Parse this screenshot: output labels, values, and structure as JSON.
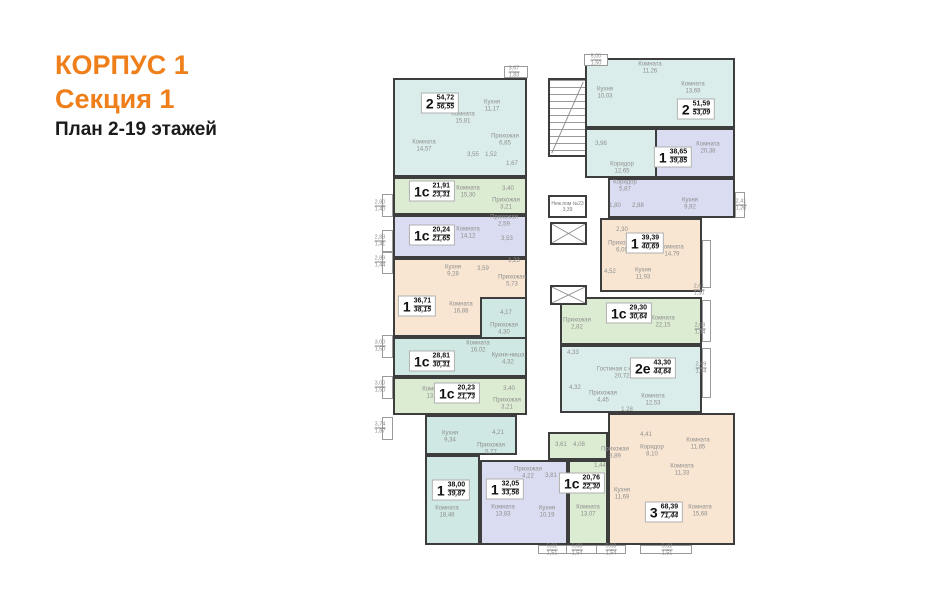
{
  "header": {
    "building": "КОРПУС 1",
    "section": "Секция 1",
    "plan": "План 2-19 этажей"
  },
  "palette": {
    "orange_accent": "#ef7f1a",
    "cyan_apt": "#daedeb",
    "green_apt": "#dcecd2",
    "lavender_apt": "#dadcf1",
    "peach_apt": "#f8e6d2",
    "teal_apt": "#cfe8e3",
    "walls": "#3d3d3d"
  },
  "apartments": [
    {
      "type": "2",
      "area_main": "54,72",
      "area_total": "56,55",
      "rooms": [
        {
          "name": "Комната",
          "area": "15,81"
        },
        {
          "name": "Комната",
          "area": "14,57"
        },
        {
          "name": "Кухня",
          "area": "11,17"
        },
        {
          "name": "Прихожая",
          "area": "6,85"
        },
        {
          "name": "",
          "area": "3,55"
        },
        {
          "name": "",
          "area": "1,52"
        },
        {
          "name": "",
          "area": "1,67"
        }
      ]
    },
    {
      "type": "1с",
      "area_main": "21,91",
      "area_total": "23,31",
      "rooms": [
        {
          "name": "Комната",
          "area": "15,30"
        },
        {
          "name": "Прихожая",
          "area": "3,21"
        },
        {
          "name": "",
          "area": "3,40"
        }
      ]
    },
    {
      "type": "1с",
      "area_main": "20,24",
      "area_total": "21,65",
      "rooms": [
        {
          "name": "Комната",
          "area": "14,12"
        },
        {
          "name": "Прихожая",
          "area": "2,59"
        },
        {
          "name": "",
          "area": "3,53"
        }
      ]
    },
    {
      "type": "1",
      "area_main": "36,71",
      "area_total": "38,15",
      "rooms": [
        {
          "name": "Комната",
          "area": "16,88"
        },
        {
          "name": "Кухня",
          "area": "9,28"
        },
        {
          "name": "Прихожая",
          "area": "5,73"
        },
        {
          "name": "",
          "area": "3,59"
        },
        {
          "name": "",
          "area": "1,23"
        }
      ]
    },
    {
      "type": "1с",
      "area_main": "28,81",
      "area_total": "30,31",
      "rooms": [
        {
          "name": "Комната",
          "area": "16,02"
        },
        {
          "name": "Кухня-ниша",
          "area": "4,32"
        },
        {
          "name": "Прихожая",
          "area": "4,30"
        },
        {
          "name": "",
          "area": "4,17"
        }
      ]
    },
    {
      "type": "1с",
      "area_main": "20,23",
      "area_total": "21,73",
      "rooms": [
        {
          "name": "Комната",
          "area": "13,62"
        },
        {
          "name": "Прихожая",
          "area": "3,21"
        },
        {
          "name": "",
          "area": "3,40"
        }
      ]
    },
    {
      "type": "1",
      "area_main": "38,00",
      "area_total": "39,87",
      "rooms": [
        {
          "name": "Комната",
          "area": "18,48"
        },
        {
          "name": "Кухня",
          "area": "9,34"
        },
        {
          "name": "Прихожая",
          "area": "5,77"
        },
        {
          "name": "",
          "area": "4,21"
        }
      ]
    },
    {
      "type": "1",
      "area_main": "32,05",
      "area_total": "33,56",
      "rooms": [
        {
          "name": "Комната",
          "area": "13,83"
        },
        {
          "name": "Кухня",
          "area": "10,19"
        },
        {
          "name": "Прихожая",
          "area": "4,22"
        },
        {
          "name": "",
          "area": "3,81"
        }
      ]
    },
    {
      "type": "1с",
      "area_main": "20,76",
      "area_total": "22,30",
      "rooms": [
        {
          "name": "Комната",
          "area": "13,07"
        },
        {
          "name": "",
          "area": "3,61"
        },
        {
          "name": "",
          "area": "4,08"
        },
        {
          "name": "",
          "area": "1,44"
        }
      ]
    },
    {
      "type": "3",
      "area_main": "68,39",
      "area_total": "71,44",
      "rooms": [
        {
          "name": "Комната",
          "area": "15,68"
        },
        {
          "name": "Комната",
          "area": "11,85"
        },
        {
          "name": "Комната",
          "area": "11,33"
        },
        {
          "name": "Кухня",
          "area": "11,69"
        },
        {
          "name": "Коридор",
          "area": "8,10"
        },
        {
          "name": "Прихожая",
          "area": "3,89"
        },
        {
          "name": "",
          "area": "4,41"
        }
      ]
    },
    {
      "type": "2е",
      "area_main": "43,30",
      "area_total": "44,64",
      "rooms": [
        {
          "name": "Гостиная с кухней",
          "area": "20,72"
        },
        {
          "name": "Комната",
          "area": "12,53"
        },
        {
          "name": "Прихожая",
          "area": "4,45"
        },
        {
          "name": "",
          "area": "4,33"
        },
        {
          "name": "",
          "area": "4,32"
        },
        {
          "name": "",
          "area": "1,28"
        }
      ]
    },
    {
      "type": "1с",
      "area_main": "29,30",
      "area_total": "30,64",
      "rooms": [
        {
          "name": "Комната",
          "area": "22,15"
        },
        {
          "name": "Прихожая",
          "area": "2,82"
        }
      ]
    },
    {
      "type": "1",
      "area_main": "39,39",
      "area_total": "40,69",
      "rooms": [
        {
          "name": "Комната",
          "area": "14,79"
        },
        {
          "name": "Кухня",
          "area": "11,93"
        },
        {
          "name": "Прихожая",
          "area": "6,05"
        },
        {
          "name": "",
          "area": "4,52"
        },
        {
          "name": "",
          "area": "2,30"
        }
      ]
    },
    {
      "type": "1",
      "area_main": "38,65",
      "area_total": "39,85",
      "rooms": [
        {
          "name": "Комната",
          "area": "20,38"
        },
        {
          "name": "Кухня",
          "area": "9,92"
        },
        {
          "name": "Коридор",
          "area": "5,87"
        },
        {
          "name": "",
          "area": "1,80"
        },
        {
          "name": "",
          "area": "2,88"
        }
      ]
    },
    {
      "type": "2",
      "area_main": "51,59",
      "area_total": "53,09",
      "rooms": [
        {
          "name": "Комната",
          "area": "11,26"
        },
        {
          "name": "Комната",
          "area": "13,69"
        },
        {
          "name": "Кухня",
          "area": "10,03"
        },
        {
          "name": "Коридор",
          "area": "12,65"
        },
        {
          "name": "",
          "area": "3,96"
        }
      ]
    }
  ],
  "core": {
    "tech_room_name": "Неж.пом №23",
    "tech_room_area": "3,39"
  },
  "dims": [
    {
      "a": "3,67",
      "b": "1,83"
    },
    {
      "a": "5,00",
      "b": "1,50"
    },
    {
      "a": "2,80",
      "b": "1,40"
    },
    {
      "a": "2,83",
      "b": "1,41"
    },
    {
      "a": "2,89",
      "b": "1,44"
    },
    {
      "a": "3,00",
      "b": "1,50"
    },
    {
      "a": "3,00",
      "b": "1,50"
    },
    {
      "a": "3,74",
      "b": "1,87"
    },
    {
      "a": "5,02",
      "b": "1,51"
    },
    {
      "a": "5,08",
      "b": "1,54"
    },
    {
      "a": "5,08",
      "b": "1,54"
    },
    {
      "a": "5,02",
      "b": "1,51"
    },
    {
      "a": "2,41",
      "b": "1,20"
    },
    {
      "a": "2,61",
      "b": "1,30"
    },
    {
      "a": "2,69",
      "b": "1,34"
    },
    {
      "a": "2,69",
      "b": "1,34"
    }
  ]
}
